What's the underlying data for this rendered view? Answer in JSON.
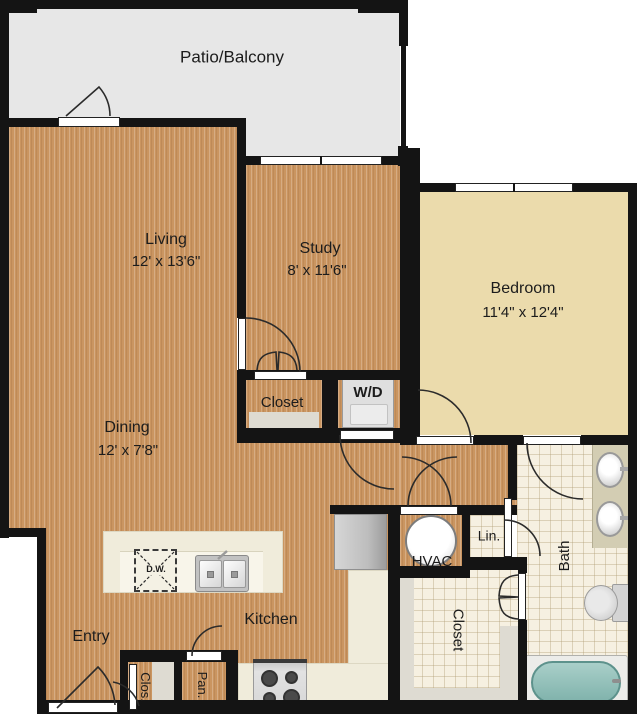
{
  "rooms": {
    "patio": {
      "name": "Patio/Balcony"
    },
    "living": {
      "name": "Living",
      "dims": "12' x 13'6\""
    },
    "study": {
      "name": "Study",
      "dims": "8' x 11'6\""
    },
    "bedroom": {
      "name": "Bedroom",
      "dims": "11'4\" x 12'4\""
    },
    "dining": {
      "name": "Dining",
      "dims": "12' x 7'8\""
    },
    "kitchen": {
      "name": "Kitchen"
    },
    "entry": {
      "name": "Entry"
    },
    "bath": {
      "name": "Bath"
    },
    "study_closet": {
      "name": "Closet"
    },
    "walkin_closet": {
      "name": "Closet"
    },
    "entry_closet": {
      "name": "Clos."
    },
    "pantry": {
      "name": "Pan."
    },
    "linen": {
      "name": "Lin."
    },
    "hvac": {
      "name": "HVAC"
    },
    "laundry": {
      "name": "W/D"
    }
  },
  "appliances": {
    "dishwasher": "D.W."
  },
  "colors": {
    "wall": "#141414",
    "wood_floor": "#ca9560",
    "bedroom_floor": "#ebdbac",
    "patio_floor": "#e7e7e7",
    "tile_floor": "#f6f0e1",
    "counter": "#f0ecdb",
    "tub_water": "#8ec0ba"
  }
}
